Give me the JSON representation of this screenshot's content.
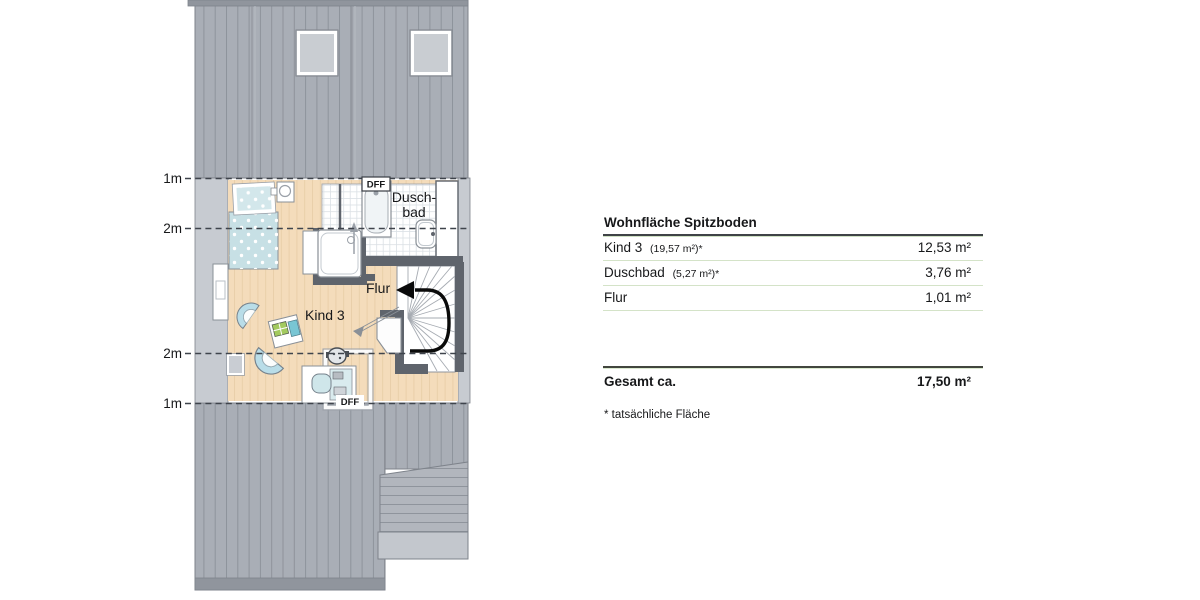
{
  "plan": {
    "labels": {
      "room_kind3": "Kind 3",
      "room_duschbad_line1": "Dusch-",
      "room_duschbad_line2": "bad",
      "room_flur": "Flur",
      "dff_top": "DFF",
      "dff_bottom": "DFF",
      "measure_1m_top": "1m",
      "measure_2m_top": "2m",
      "measure_2m_bottom": "2m",
      "measure_1m_bottom": "1m"
    }
  },
  "table": {
    "title": "Wohnfläche Spitzboden",
    "rows": [
      {
        "name": "Kind 3",
        "note": "(19,57 m²)*",
        "value": "12,53 m²"
      },
      {
        "name": "Duschbad",
        "note": "(5,27 m²)*",
        "value": "3,76 m²"
      },
      {
        "name": "Flur",
        "note": "",
        "value": "1,01 m²"
      }
    ],
    "total_label": "Gesamt ca.",
    "total_value": "17,50 m²",
    "footnote": "* tatsächliche Fläche"
  },
  "colors": {
    "roof_gray": "#a9aeb6",
    "roof_stripe": "#8e939b",
    "under_eave_gray": "#c7cbd1",
    "floor_wood": "#f4dcbb",
    "wall_dark": "#5f646c",
    "furniture_blue": "#c7e0e5",
    "row_divider_green": "#d4e3c8",
    "heavy_line": "#3f4347"
  }
}
